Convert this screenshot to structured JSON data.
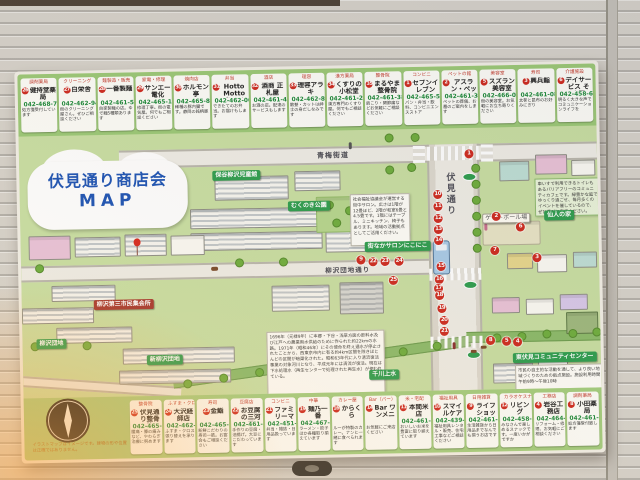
{
  "sign": {
    "title_line1": "伏見通り商店会",
    "title_line2": "MAP",
    "colors": {
      "band_green": "#9cc977",
      "map_green": "#c9dfa3",
      "marker_red": "#cf2b20",
      "title_blue": "#1f55b5",
      "phone_green": "#1e8a3a",
      "label_green": "#2f9e4f"
    },
    "top_cards": [
      {
        "num": "26",
        "cat": "調剤薬局",
        "name": "健持堂薬局",
        "phone": "042-468-7788",
        "desc": "処方箋受付しています"
      },
      {
        "num": "27",
        "cat": "クリーニング",
        "name": "白栄舎",
        "phone": "042-462-9424",
        "desc": "街のクリーニング屋さん。ぜひご相談ください"
      },
      {
        "num": "28",
        "cat": "麺製造・販売",
        "name": "一番製麺",
        "phone": "042-461-5163",
        "desc": "自家製麺の店。ゆで麺5種類あります"
      },
      {
        "num": "29",
        "cat": "家電・修理",
        "name": "サンエー電化",
        "phone": "042-465-1077",
        "desc": "修理丁寧。街の電気屋。何でもご相談ください"
      },
      {
        "num": "30",
        "cat": "焼肉店",
        "name": "ホルモン亭",
        "phone": "042-465-8766",
        "desc": "稀種の豚内臓です。静岡の銘柄豚"
      },
      {
        "num": "31",
        "cat": "弁当",
        "name": "Hotto Motto（ほっともっと）",
        "phone": "042-462-0047",
        "desc": "できたてのお弁当。お届けもします"
      },
      {
        "num": "32",
        "cat": "酒店",
        "name": "酒商 正札屋",
        "phone": "042-461-4968",
        "desc": "お酒の店。配達のサービスもします"
      },
      {
        "num": "33",
        "cat": "理容",
        "name": "理容アラキ",
        "phone": "042-462-8923",
        "desc": "散髪・カットは紳士の身だしなみです"
      },
      {
        "num": "34",
        "cat": "漢方薬局",
        "name": "くすりの小松堂",
        "phone": "042-461-2532",
        "desc": "漢方専門のくすり屋。何でもご相談ください"
      },
      {
        "num": "35",
        "cat": "整骨院",
        "name": "まるやま整骨院",
        "phone": "042-461-3891",
        "desc": "肩こり・関節痛などお気軽にご相談ください"
      },
      {
        "num": "1",
        "cat": "コンビニ",
        "name": "セブンイレブン",
        "phone": "042-465-5711",
        "desc": "パン・弁当・飲料、コンビニエンスストア"
      },
      {
        "num": "2",
        "cat": "ペットの館",
        "name": "アスラン・ペットメモリアル",
        "phone": "042-461-3319",
        "desc": "ペットの葬儀、お墓のご案内をします"
      },
      {
        "num": "5",
        "cat": "美容室",
        "name": "スズラン美容室",
        "phone": "042-466-0696",
        "desc": "街の美容室。お気軽にお立ち寄りください"
      },
      {
        "num": "3",
        "cat": "寿司",
        "name": "興兵鮨",
        "phone": "042-461-0839",
        "desc": "太巻と昆布のお好みにぎり"
      },
      {
        "num": "6",
        "cat": "介護施設",
        "name": "デイサービス そよ園",
        "phone": "042-458-6681",
        "desc": "明るく大きな声でコミュニケーションライフを"
      }
    ],
    "bottom_cards": [
      {
        "num": "25",
        "cat": "整骨院",
        "name": "伏見通り整骨院",
        "phone": "042-465-5552",
        "desc": "腰痛・膝の痛みなど、やわらぎ治療に努めます"
      },
      {
        "num": "24",
        "cat": "ふすま・クロス",
        "name": "大沢経師店",
        "phone": "042-462-3461",
        "desc": "ふすま・クロス張り替えを承ります"
      },
      {
        "num": "23",
        "cat": "寿司",
        "name": "金鮨",
        "phone": "042-465-9466",
        "desc": "新鮮こだわりの寿司一筋。お宴会もご相談ください"
      },
      {
        "num": "22",
        "cat": "豆腐店",
        "name": "お豆腐の三河屋",
        "phone": "042-461-4966",
        "desc": "手作りの豆腐・油揚げ。大豆にこだわっています"
      },
      {
        "num": "21",
        "cat": "コンビニ",
        "name": "ファミリーマート",
        "phone": "042-451-5423",
        "desc": "弁当・雑誌・日用品扱っています"
      },
      {
        "num": "19",
        "cat": "中華",
        "name": "麺乃一番",
        "phone": "042-467-2939",
        "desc": "ラーメン・餃子ほか各種取り揃えています"
      },
      {
        "num": "16",
        "cat": "カレー屋",
        "name": "からくら",
        "phone": "",
        "desc": "ルーが特製のカレー。ナンと一緒に食べられます"
      },
      {
        "num": "14",
        "cat": "Bar（バー）",
        "name": "Bar ワンメニー",
        "phone": "",
        "desc": "お気軽にご来店ください"
      },
      {
        "num": "11",
        "cat": "米・宅配",
        "name": "本間米店",
        "phone": "042-461-2721",
        "desc": "おいしいお米を豊富に取り揃えています"
      },
      {
        "num": "10",
        "cat": "福祉用具",
        "name": "スマイルケア",
        "phone": "042-439-6544",
        "desc": "福祉用具レンタル・販売、住宅工事などご相談ください"
      },
      {
        "num": "9",
        "cat": "日用雑貨",
        "name": "ライフショップワイルド",
        "phone": "042-461-2766",
        "desc": "生活雑貨から日用品までなんでも揃うお店です"
      },
      {
        "num": "12",
        "cat": "カラオケスナック",
        "name": "リビング",
        "phone": "042-458-8365",
        "desc": "みなさんで楽しめるスナックです。一度いかがですか"
      },
      {
        "num": "4",
        "cat": "工務店",
        "name": "岩谷工務店",
        "phone": "042-464-0694",
        "desc": "リフォーム・修理、お気軽にご相談ください"
      },
      {
        "num": "8",
        "cat": "調剤薬局",
        "name": "小田薬局",
        "phone": "042-461-8559",
        "desc": "処方箋受付致します"
      }
    ],
    "map": {
      "labels": {
        "ome_kaido": "青梅街道",
        "fushimi_dori": "伏見通り",
        "danchi_dori": "柳沢団地通り",
        "jidokan": "保谷柳沢児童館",
        "mukunoki": "むくのき公園",
        "salon": "街なかサロンにこにこ",
        "sennin": "仙人の家",
        "community": "東伏見コミュニティセンター",
        "shin_yagisawa": "新柳沢団地",
        "yagisawa_danchi": "柳沢団地",
        "shukaijo": "柳沢第三市民集会所",
        "senkawa": "千川上水",
        "gateball": "ゲートボール場"
      },
      "boxes": {
        "salon": "社会福祉協議会が運営する街中サロン。広さは1階が12畳ほど、2階が和室6畳と4.5畳です。1階にはテーブル、ミニキッチン、椅子もあります。地域の活動拠点としてご活用ください。",
        "sennin": "車いすで利用できるトイレもあるバリアフリーのコミュニティカフェです。緑豊かな庭でゆっくり過ごせ、毎月多くのイベントを催しているので、ぜひ遊びに来てください。",
        "community": "市民の自主的な活動を通して、より良い地域づくりのための拠点施設。施設利用時間 午前9時〜午後10時",
        "senkawa": "1696年（元禄9年）に本郷・下谷・浅草方面の飲料水及び江戸への農業用水供給のために作られた約22kmの水路。1971年（昭和46年）にその使命を終え通水が停止されたことから、西東京市内に有る約4km区間を除きほとんどの区間が暗渠化された。昭和63年代に入り清流復活事業の対象河川となり、平成元年には清流が復活。現在は下水処理水（再生センターで処理された再生水）が使われている。",
        "disclaimer": "イラストマップはイメージです。建物の形や位置は正確ではありません。"
      },
      "markers": [
        {
          "n": "1",
          "x": 450,
          "y": 26
        },
        {
          "n": "10",
          "x": 418,
          "y": 66
        },
        {
          "n": "11",
          "x": 418,
          "y": 78
        },
        {
          "n": "12",
          "x": 418,
          "y": 90
        },
        {
          "n": "13",
          "x": 418,
          "y": 101
        },
        {
          "n": "14",
          "x": 418,
          "y": 112
        },
        {
          "n": "2",
          "x": 476,
          "y": 89
        },
        {
          "n": "6",
          "x": 500,
          "y": 100
        },
        {
          "n": "7",
          "x": 474,
          "y": 123
        },
        {
          "n": "3",
          "x": 516,
          "y": 131
        },
        {
          "n": "8",
          "x": 468,
          "y": 213
        },
        {
          "n": "5",
          "x": 484,
          "y": 214
        },
        {
          "n": "4",
          "x": 495,
          "y": 215
        },
        {
          "n": "9",
          "x": 340,
          "y": 130
        },
        {
          "n": "22",
          "x": 352,
          "y": 132
        },
        {
          "n": "23",
          "x": 364,
          "y": 132
        },
        {
          "n": "24",
          "x": 378,
          "y": 132
        },
        {
          "n": "25",
          "x": 372,
          "y": 151
        },
        {
          "n": "15",
          "x": 420,
          "y": 138
        },
        {
          "n": "16",
          "x": 418,
          "y": 151
        },
        {
          "n": "17",
          "x": 417,
          "y": 160
        },
        {
          "n": "18",
          "x": 418,
          "y": 167
        },
        {
          "n": "19",
          "x": 420,
          "y": 180
        },
        {
          "n": "20",
          "x": 422,
          "y": 192
        },
        {
          "n": "21",
          "x": 422,
          "y": 203
        }
      ]
    }
  }
}
